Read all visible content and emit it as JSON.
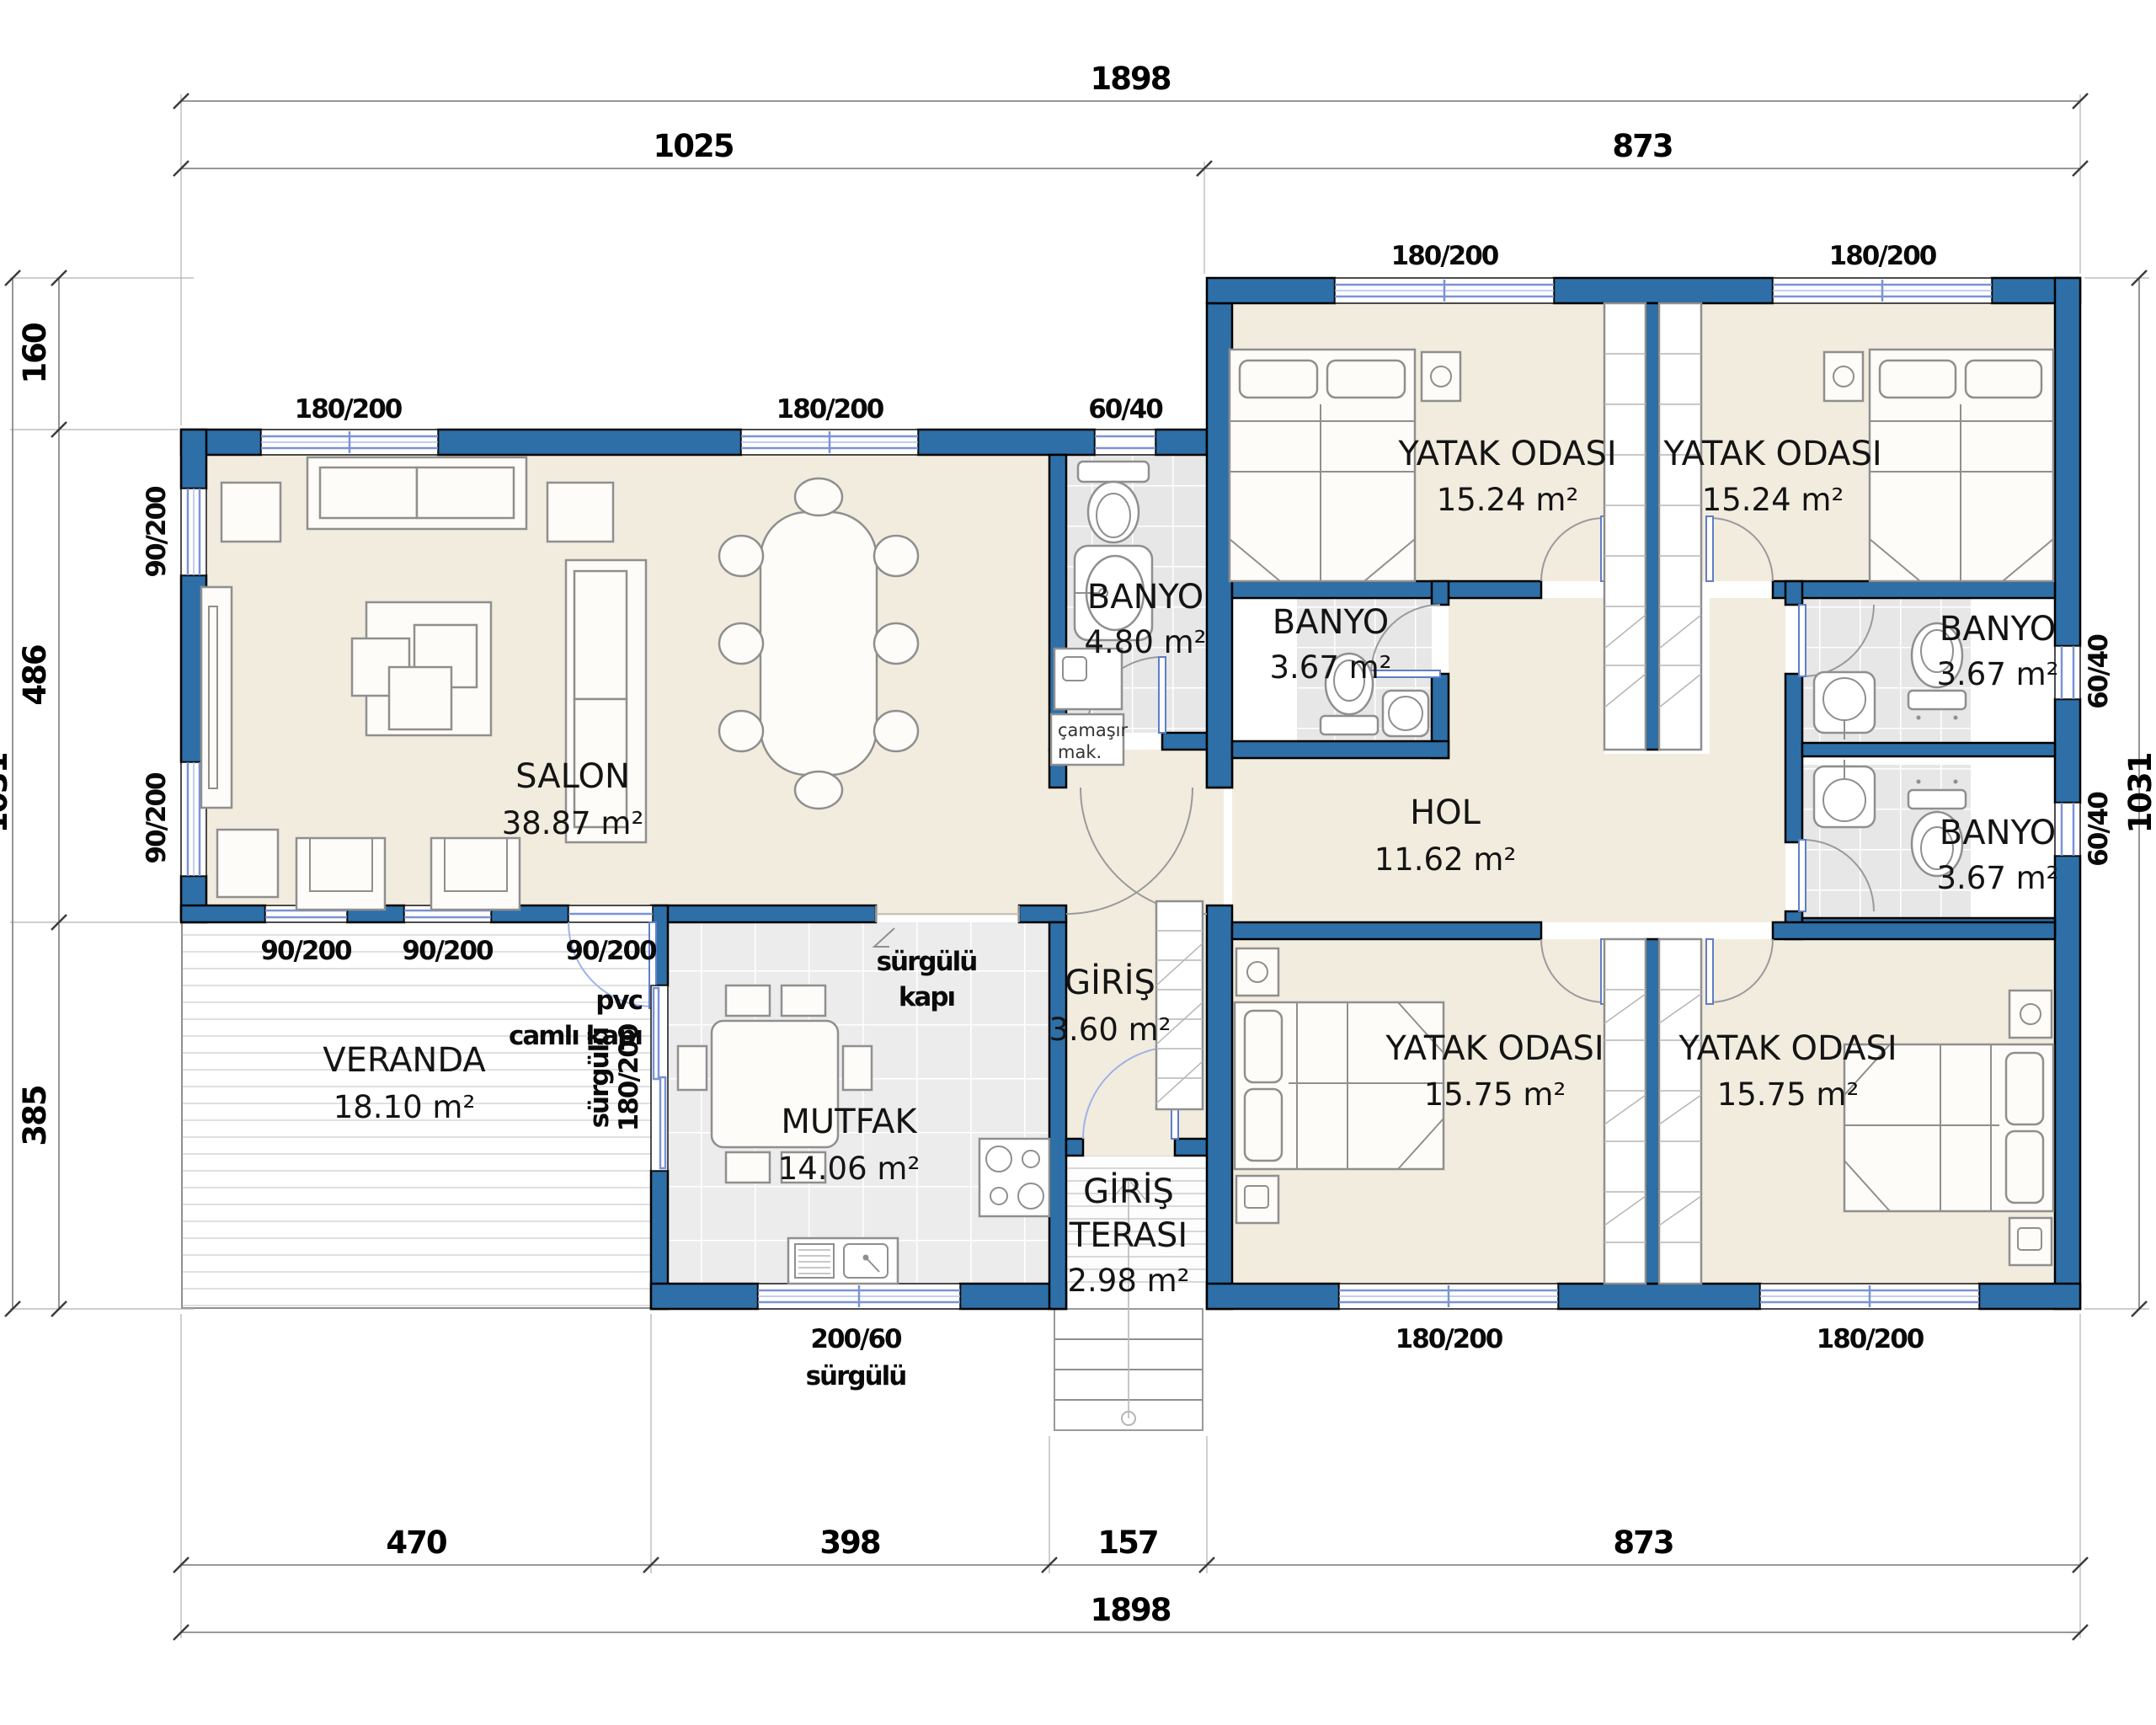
{
  "colors": {
    "wall_blue": "#2e6fa7",
    "floor_cream": "#f2ecdf",
    "tile_gray": "#e8e8e8",
    "window_frame_blue": "#7b93d6"
  },
  "dimensions": {
    "top_overall": "1898",
    "top_left": "1025",
    "top_right": "873",
    "bottom_1": "470",
    "bottom_2": "398",
    "bottom_3": "157",
    "bottom_4": "873",
    "bottom_overall": "1898",
    "left_1": "160",
    "left_2": "486",
    "left_3": "385",
    "left_overall": "1031",
    "right_overall": "1031"
  },
  "rooms": {
    "salon": {
      "name": "SALON",
      "area": "38.87 m²"
    },
    "mutfak": {
      "name": "MUTFAK",
      "area": "14.06 m²"
    },
    "veranda": {
      "name": "VERANDA",
      "area": "18.10 m²"
    },
    "giris": {
      "name": "GİRİŞ",
      "area": "3.60 m²"
    },
    "giris_terasi": {
      "name_line1": "GİRİŞ",
      "name_line2": "TERASI",
      "area": "2.98 m²"
    },
    "hol": {
      "name": "HOL",
      "area": "11.62 m²"
    },
    "banyo_1": {
      "name": "BANYO",
      "area": "4.80 m²"
    },
    "banyo_2": {
      "name": "BANYO",
      "area": "3.67 m²"
    },
    "banyo_3": {
      "name": "BANYO",
      "area": "3.67 m²"
    },
    "banyo_4": {
      "name": "BANYO",
      "area": "3.67 m²"
    },
    "yatak_1": {
      "name": "YATAK ODASI",
      "area": "15.24 m²"
    },
    "yatak_2": {
      "name": "YATAK ODASI",
      "area": "15.24 m²"
    },
    "yatak_3": {
      "name": "YATAK ODASI",
      "area": "15.75 m²"
    },
    "yatak_4": {
      "name": "YATAK ODASI",
      "area": "15.75 m²"
    }
  },
  "openings": {
    "salon_top_1": "180/200",
    "salon_top_2": "180/200",
    "banyo1_top": "60/40",
    "bed1_top": "180/200",
    "bed2_top": "180/200",
    "salon_left_1": "90/200",
    "salon_left_2": "90/200",
    "veranda_1": "90/200",
    "veranda_2": "90/200",
    "veranda_door": "90/200",
    "veranda_door_note1": "pvc",
    "veranda_door_note2": "camlı kapı",
    "kitchen_slide_1": "sürgülü",
    "kitchen_slide_2": "kapı",
    "kitchen_veranda_1": "180/200",
    "kitchen_veranda_2": "sürgülü",
    "kitchen_bottom_1": "200/60",
    "kitchen_bottom_2": "sürgülü",
    "bed3_bottom": "180/200",
    "bed4_bottom": "180/200",
    "banyo3_right": "60/40",
    "banyo4_right": "60/40",
    "washer_1": "çamaşır",
    "washer_2": "mak."
  }
}
